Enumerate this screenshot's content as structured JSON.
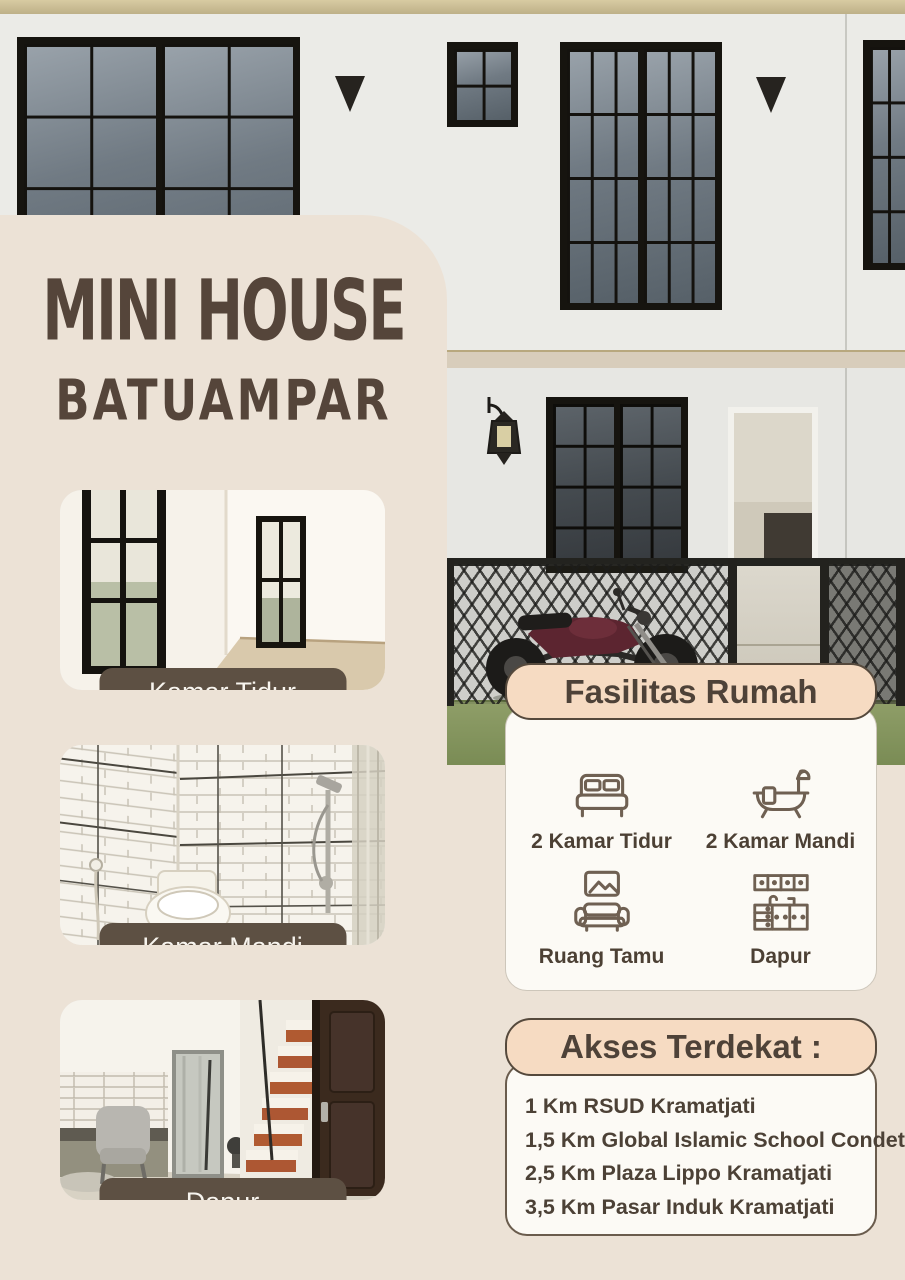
{
  "poster": {
    "title": {
      "line1": "MINI HOUSE",
      "line2": "BATUAMPAR"
    },
    "photos": [
      {
        "name": "bedroom-photo",
        "label": "Kamar Tidur"
      },
      {
        "name": "bathroom-photo",
        "label": "Kamar Mandi"
      },
      {
        "name": "kitchen-photo",
        "label": "Dapur"
      }
    ],
    "facilities": {
      "title": "Fasilitas Rumah",
      "items": [
        {
          "icon": "bed-icon",
          "label": "2 Kamar Tidur"
        },
        {
          "icon": "bathtub-icon",
          "label": "2 Kamar Mandi"
        },
        {
          "icon": "sofa-icon",
          "label": "Ruang Tamu"
        },
        {
          "icon": "kitchen-icon",
          "label": "Dapur"
        }
      ]
    },
    "access": {
      "title": "Akses Terdekat :",
      "items": [
        "1 Km RSUD Kramatjati",
        "1,5 Km Global Islamic School Condet",
        "2,5 Km Plaza Lippo Kramatjati",
        "3,5 Km Pasar Induk Kramatjati"
      ]
    },
    "colors": {
      "panel": "#ece2d6",
      "card-header": "#f6dbc2",
      "card-body": "#fcfaf5",
      "title-text": "#55453a",
      "pill": "#5d5043",
      "pill-text": "#f7f4ee",
      "icon-stroke": "#6f6052",
      "border-dark": "#55493c"
    }
  }
}
